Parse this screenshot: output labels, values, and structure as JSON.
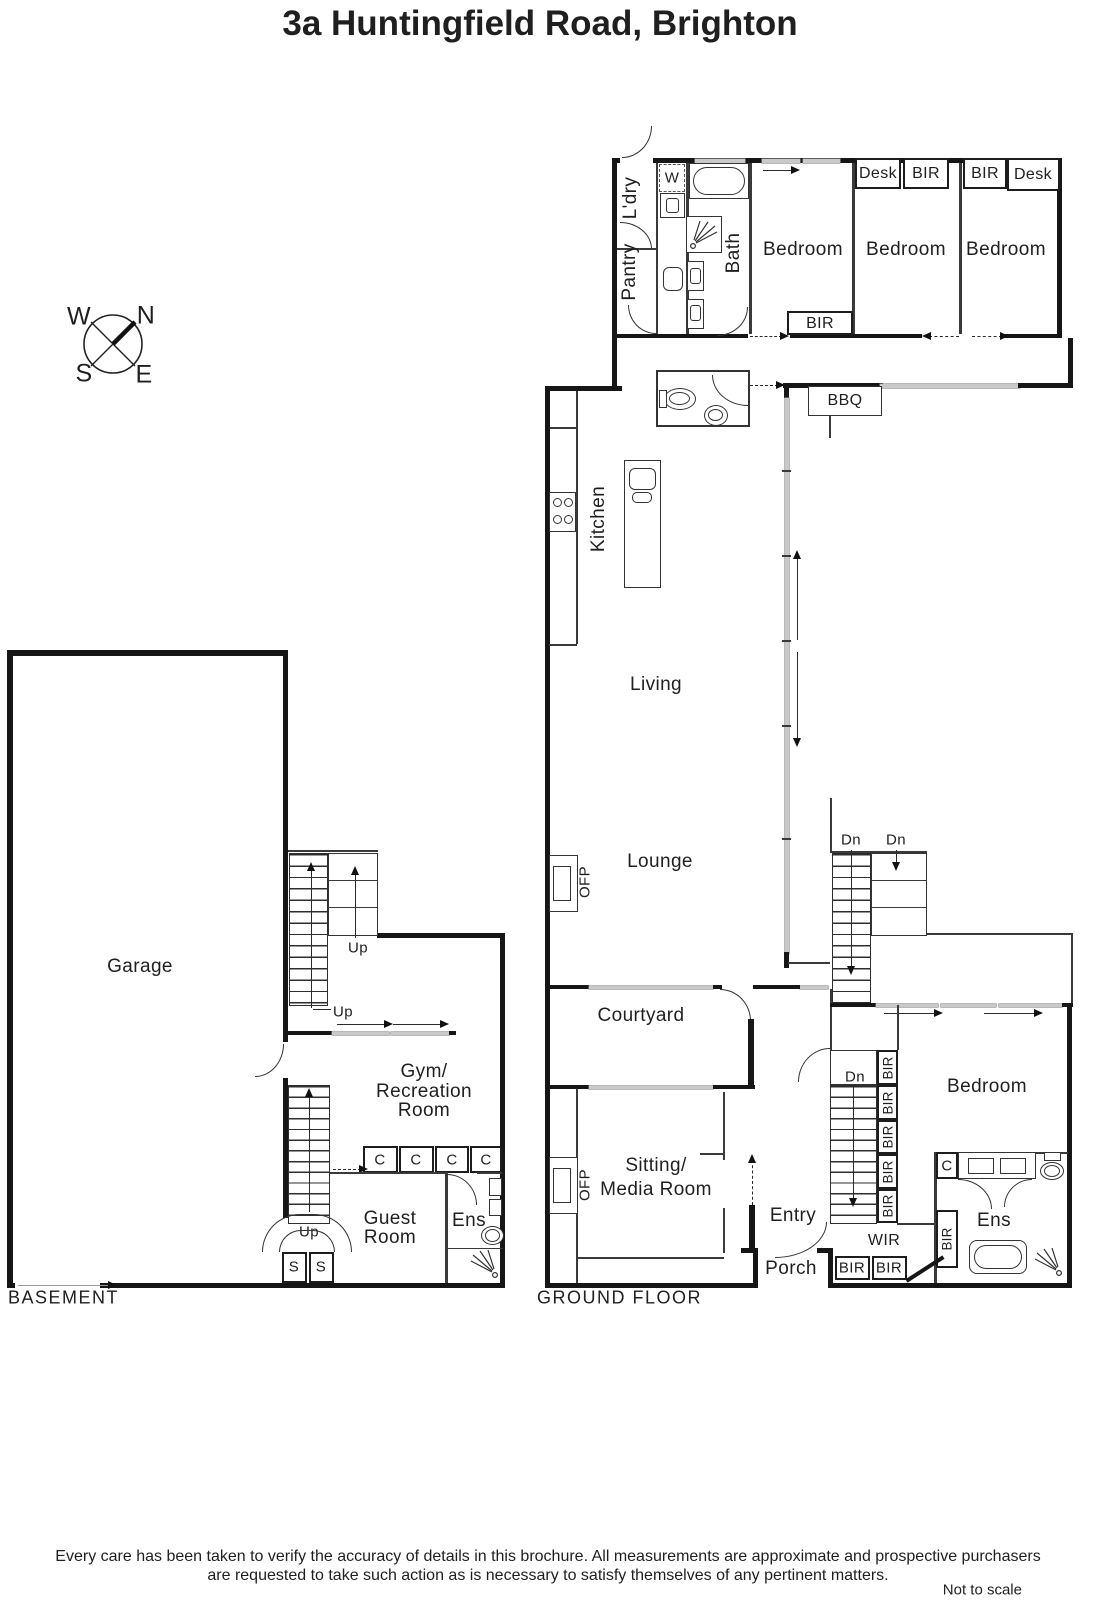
{
  "title": "3a Huntingfield Road, Brighton",
  "compass": {
    "n": "N",
    "e": "E",
    "s": "S",
    "w": "W"
  },
  "floor_labels": {
    "basement": "BASEMENT",
    "ground": "GROUND FLOOR"
  },
  "rooms": {
    "ldry": "L'dry",
    "pantry": "Pantry",
    "bath": "Bath",
    "bedroom": "Bedroom",
    "kitchen": "Kitchen",
    "living": "Living",
    "lounge": "Lounge",
    "courtyard": "Courtyard",
    "sitting_line1": "Sitting/",
    "sitting_line2": "Media Room",
    "gym_line1": "Gym/",
    "gym_line2": "Recreation",
    "gym_line3": "Room",
    "guest_line1": "Guest",
    "guest_line2": "Room",
    "garage": "Garage",
    "ens": "Ens",
    "entry": "Entry",
    "porch": "Porch",
    "wir": "WIR"
  },
  "fixtures": {
    "w": "W",
    "bir": "BIR",
    "desk": "Desk",
    "bbq": "BBQ",
    "ofp": "OFP",
    "c": "C",
    "s": "S",
    "up": "Up",
    "dn": "Dn"
  },
  "footer": {
    "line1": "Every care has been taken to verify the accuracy of details in this brochure.  All measurements are approximate and prospective purchasers",
    "line2": "are requested to take such action as is necessary to satisfy themselves of any pertinent matters.",
    "scale": "Not to scale"
  }
}
